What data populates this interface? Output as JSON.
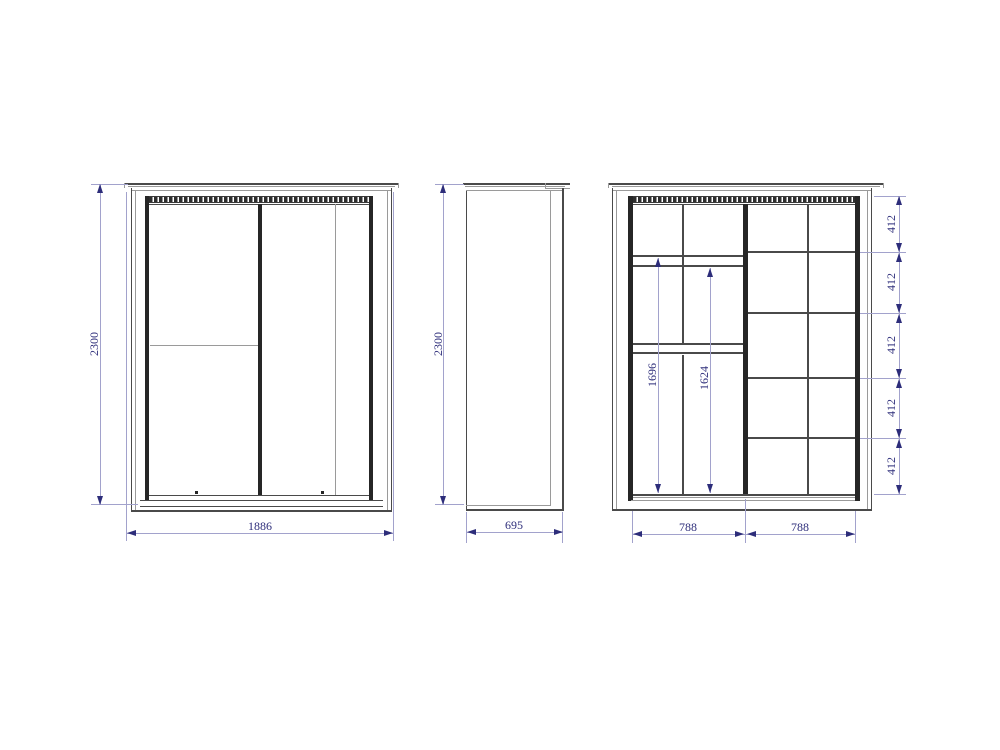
{
  "views": {
    "front": {
      "height_label": "2300",
      "width_label": "1886"
    },
    "side": {
      "height_label": "2300",
      "depth_label": "695"
    },
    "internal": {
      "hang_height_labels": [
        "1696",
        "1624"
      ],
      "shelf_spacing_labels": [
        "412",
        "412",
        "412",
        "412",
        "412"
      ],
      "section_width_labels": [
        "788",
        "788"
      ]
    }
  },
  "colors": {
    "background": "#ffffff",
    "object_line": "#4a4a4a",
    "heavy_line": "#262626",
    "dimension_line": "#a2a2cc",
    "dimension_text": "#2d2d7a"
  }
}
